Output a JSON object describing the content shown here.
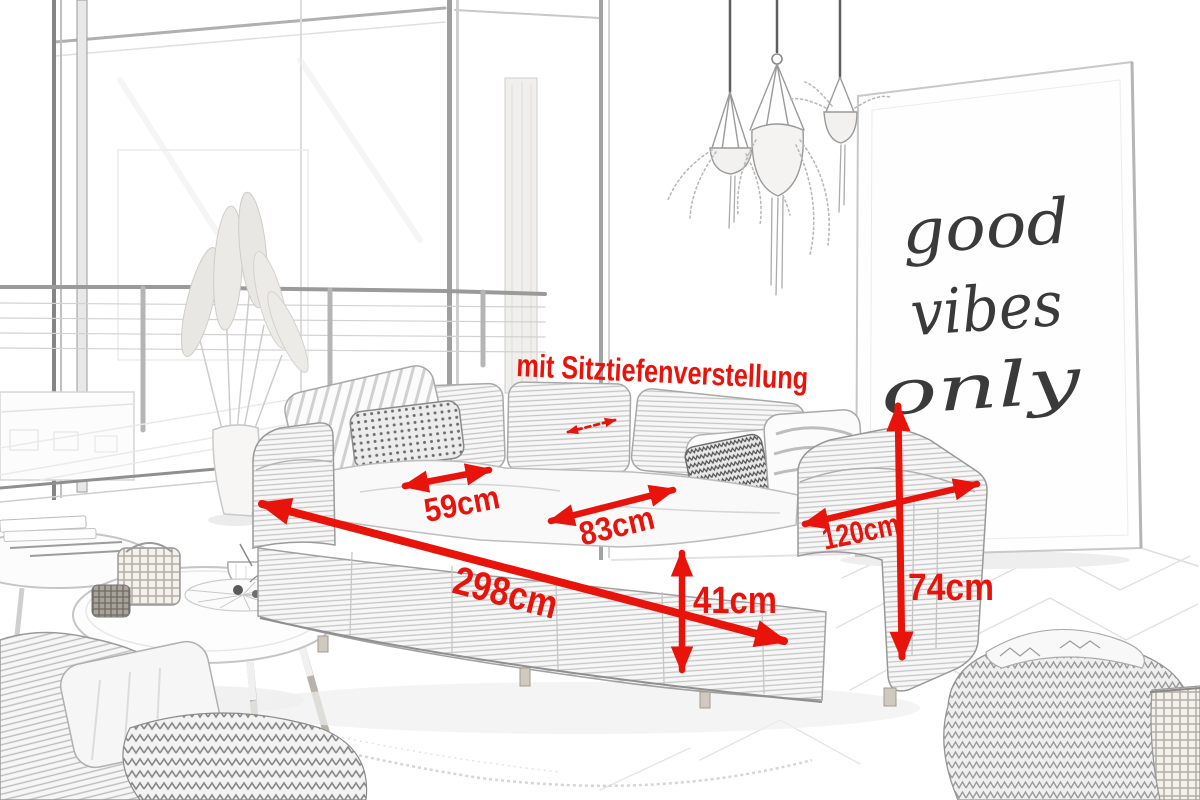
{
  "style": {
    "accent_red": "#e8130a",
    "sketch_ink": "#8a8a8a",
    "background": "#ffffff"
  },
  "annotations": {
    "note": "mit Sitztiefenverstellung",
    "dimensions": [
      {
        "name": "total-width",
        "label": "298cm"
      },
      {
        "name": "seat-width",
        "label": "59cm"
      },
      {
        "name": "seat-depth",
        "label": "83cm"
      },
      {
        "name": "seat-height",
        "label": "41cm"
      },
      {
        "name": "side-depth",
        "label": "120cm"
      },
      {
        "name": "total-height",
        "label": "74cm"
      }
    ]
  },
  "poster": {
    "lines": [
      "good",
      "vibes",
      "only"
    ]
  }
}
